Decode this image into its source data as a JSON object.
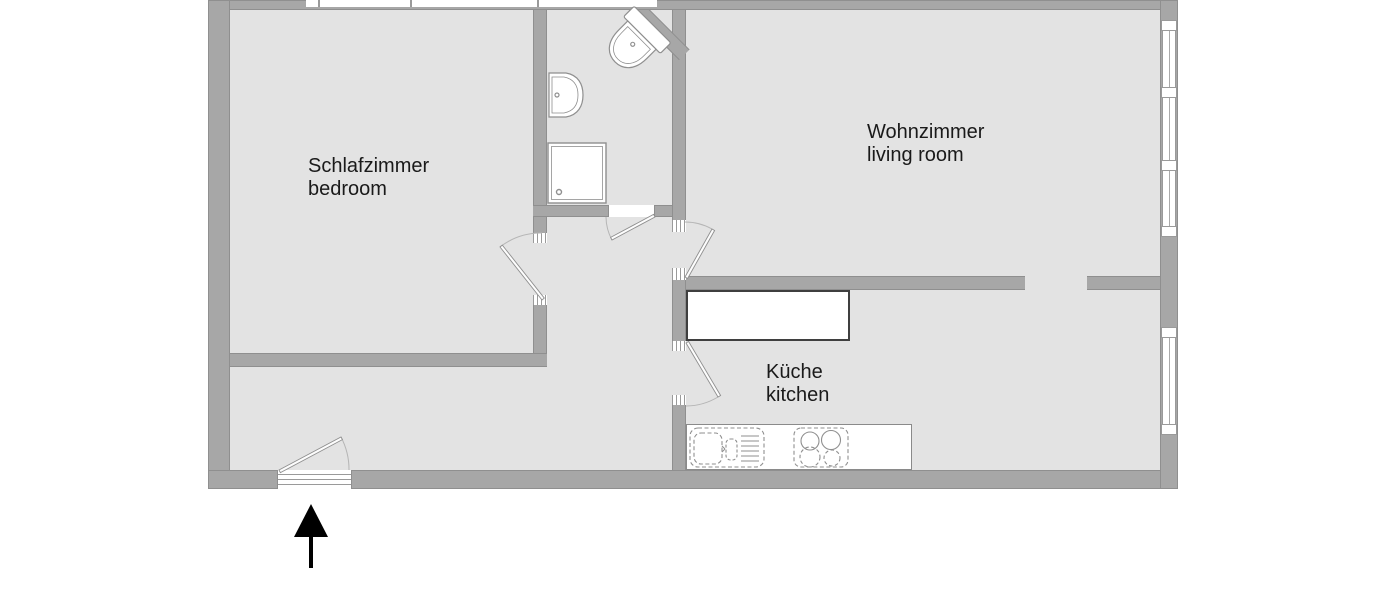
{
  "floorplan": {
    "rooms": [
      {
        "id": "bedroom",
        "name_de": "Schlafzimmer",
        "name_en": "bedroom"
      },
      {
        "id": "living-room",
        "name_de": "Wohnzimmer",
        "name_en": "living room"
      },
      {
        "id": "kitchen",
        "name_de": "Küche",
        "name_en": "kitchen"
      }
    ],
    "fixtures": [
      "toilet-icon",
      "washbasin-icon",
      "shower-icon",
      "kitchen-counter",
      "kitchen-sink-icon",
      "stove-icon"
    ],
    "entrance": {
      "direction": "up"
    },
    "colors": {
      "wall": "#a7a7a7",
      "wall_edge": "#8f8f8f",
      "floor": "#e3e3e3",
      "background": "#ffffff",
      "fixture_outline": "#8f8f8f",
      "label_text": "#1a1a1a",
      "entrance_arrow": "#000000"
    }
  }
}
